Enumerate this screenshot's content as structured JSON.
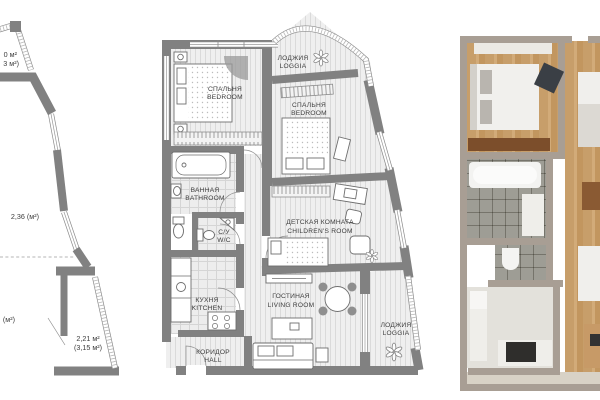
{
  "colors": {
    "background": "#ffffff",
    "wall_gray": "#818181",
    "floor_light": "#efefef",
    "label_text": "#3d3d3d",
    "render_wall": "#a89e94",
    "render_wood": "#c79e6a",
    "render_tile": "#c9c8c3"
  },
  "left_plan": {
    "labels": {
      "top_area_line1": "0 м²",
      "top_area_line2": "3 м²)",
      "mid_area": "2,36 (м²)",
      "lower_area": "(м²)",
      "loggia_area_line1": "2,21 м²",
      "loggia_area_line2": "(3,15 м²)"
    }
  },
  "floor_plan": {
    "rooms": {
      "bedroom1": {
        "ru": "СПАЛЬНЯ",
        "en": "BEDROOM"
      },
      "loggia_top": {
        "ru": "ЛОДЖИЯ",
        "en": "LOGGIA"
      },
      "bedroom2": {
        "ru": "СПАЛЬНЯ",
        "en": "BEDROOM"
      },
      "bathroom": {
        "ru": "ВАННАЯ",
        "en": "BATHROOM"
      },
      "wc": {
        "ru": "С/У",
        "en": "W/C"
      },
      "children": {
        "ru": "ДЕТСКАЯ КОМНАТА",
        "en": "CHILDREN'S ROOM"
      },
      "kitchen": {
        "ru": "КУХНЯ",
        "en": "KITCHEN"
      },
      "hall": {
        "ru": "КОРИДОР",
        "en": "HALL"
      },
      "living": {
        "ru": "ГОСТИНАЯ",
        "en": "LIVING ROOM"
      },
      "loggia_bottom": {
        "ru": "ЛОДЖИЯ",
        "en": "LOGGIA"
      }
    }
  }
}
